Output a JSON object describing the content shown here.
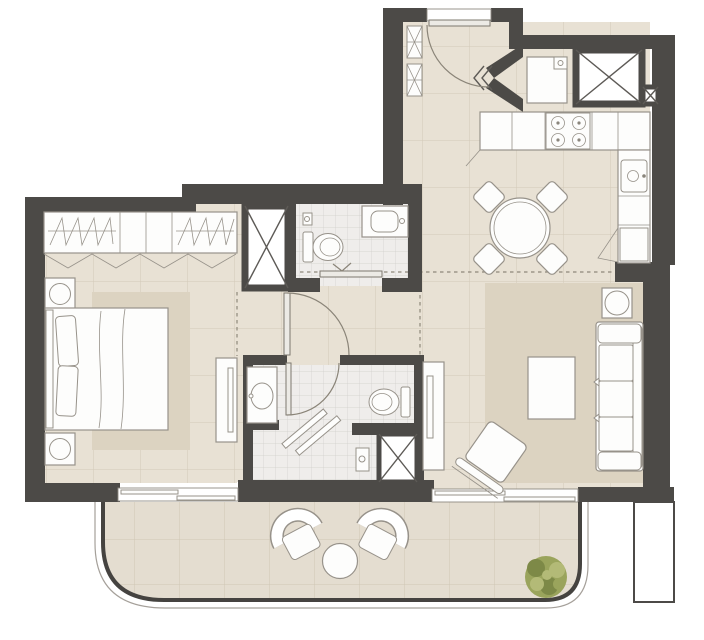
{
  "plan": {
    "kind": "residential-apartment-floor-plan",
    "rooms": [
      {
        "id": "bedroom",
        "label": "bedroom",
        "fixtures": [
          "double-bed",
          "two-pillows",
          "nightstand-with-lamp-top",
          "nightstand-with-lamp-bottom",
          "wardrobe-with-hanging-rails",
          "bifold-wardrobe-doors",
          "area-rug",
          "dresser-console"
        ]
      },
      {
        "id": "bathroom-guest",
        "label": "guest-bathroom",
        "fixtures": [
          "toilet",
          "washbasin-counter",
          "inward-door",
          "utility-shaft"
        ]
      },
      {
        "id": "bathroom-ensuite",
        "label": "ensuite-bathroom",
        "fixtures": [
          "vanity-basin",
          "toilet",
          "walk-in-shower",
          "shower-screen",
          "shower-column",
          "utility-shaft",
          "inward-door"
        ]
      },
      {
        "id": "hallway",
        "label": "entrance-hall",
        "fixtures": [
          "entry-door-with-swing",
          "duct-box-upper",
          "duct-box-lower",
          "bedroom-door-swing"
        ]
      },
      {
        "id": "kitchen",
        "label": "kitchen",
        "fixtures": [
          "refrigerator",
          "built-in-closet",
          "small-duct",
          "counter-run",
          "hob-4-burners",
          "sink-unit",
          "appliance-unit",
          "angled-entry-walls"
        ]
      },
      {
        "id": "living-dining",
        "label": "living-dining-room",
        "fixtures": [
          "round-dining-table",
          "four-dining-chairs",
          "three-seat-sofa",
          "coffee-table",
          "accent-armchair",
          "round-side-table",
          "tv-console",
          "area-rug"
        ]
      },
      {
        "id": "balcony",
        "label": "balcony",
        "fixtures": [
          "lounge-chair-left",
          "lounge-chair-right",
          "round-bistro-table",
          "potted-plant",
          "curved-railing",
          "sliding-door-bedroom",
          "sliding-door-living"
        ]
      }
    ],
    "counts": {
      "hob_burners": 4,
      "dining_chairs": 4,
      "balcony_chairs": 2,
      "utility_shafts": 4,
      "sliding_doors": 2,
      "swing_doors": 4
    }
  },
  "colors": {
    "wall": "#4c4a47",
    "floor": "#e8e1d4",
    "bath": "#efedeb",
    "balcony": "#e4ddd0",
    "rug": "#dcd3c1",
    "line": "#97928a",
    "plant": "#9aa45c",
    "plantDark": "#7d8947",
    "plantLight": "#b3ba77"
  }
}
